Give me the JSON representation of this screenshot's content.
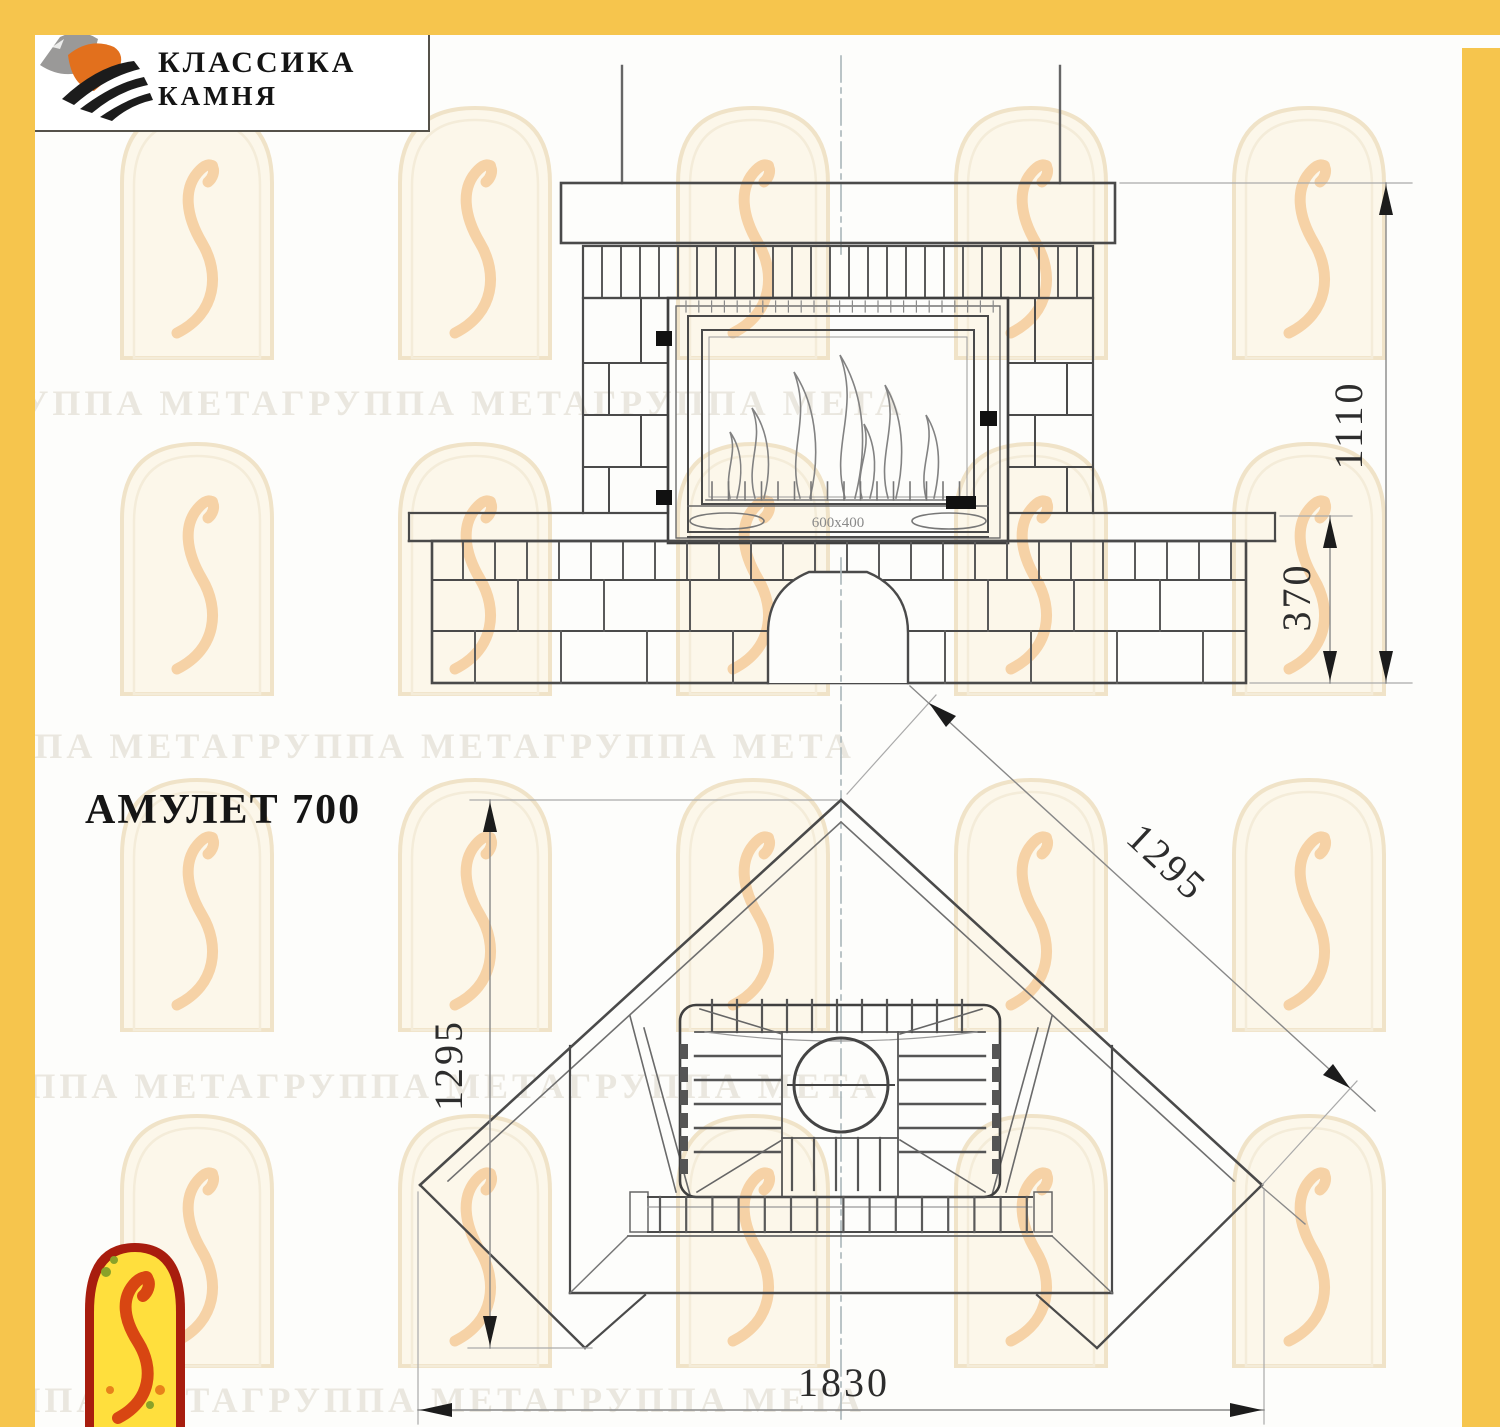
{
  "logo": {
    "line1": "КЛАССИКА",
    "line2": "КАМНЯ"
  },
  "title": "АМУЛЕТ 700",
  "watermark": {
    "text": "ГРУППА МЕТАГРУППА МЕТАГРУППА МЕТА"
  },
  "front_view": {
    "height_total": "1110",
    "bench_height": "370",
    "insert_plate": "600x400"
  },
  "plan_view": {
    "side_left": "1295",
    "side_right": "1295",
    "front_width": "1830"
  },
  "colors": {
    "border_yellow": "#f6c54d",
    "emblem_red": "#a81d0e",
    "emblem_yellow": "#ffdf3d",
    "logo_orange": "#e2701d",
    "logo_gray": "#9a9998",
    "drawing_line": "#4a4a4a",
    "centerline": "#a9b6ba",
    "watermark_text": "#eae7df"
  }
}
